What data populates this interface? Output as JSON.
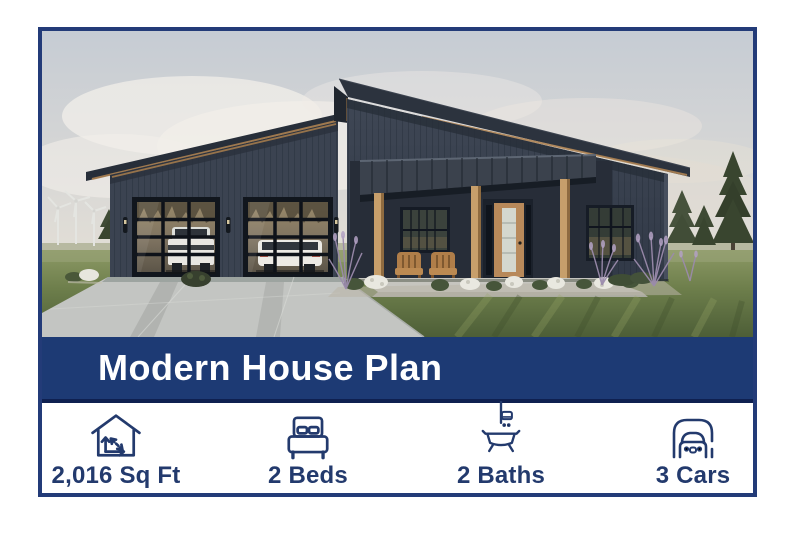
{
  "card": {
    "title": "Modern House Plan",
    "photo_alt": "Rendering of a modern single-story house with dark siding, two glass garage doors, covered porch, wind turbines and pine trees in the background",
    "stats": [
      {
        "id": "sqft",
        "icon": "floor-area-icon",
        "label": "2,016 Sq Ft"
      },
      {
        "id": "beds",
        "icon": "bed-icon",
        "label": "2 Beds"
      },
      {
        "id": "baths",
        "icon": "bath-icon",
        "label": "2 Baths"
      },
      {
        "id": "cars",
        "icon": "car-icon",
        "label": "3 Cars"
      }
    ],
    "colors": {
      "banner": "#1d3a74",
      "border": "#233b78",
      "accent_text": "#233a6d",
      "footer_bg": "#ffffff",
      "banner_text": "#ffffff"
    }
  }
}
